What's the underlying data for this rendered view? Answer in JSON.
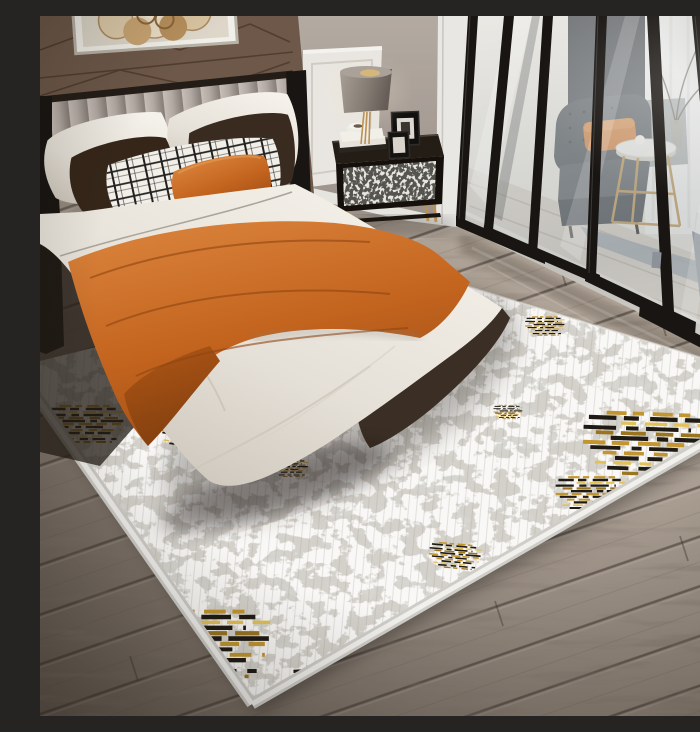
{
  "scene": {
    "setting": "modern bedroom staging photograph",
    "focus": "Distressed abstract area rug in gray, cream, gold and black under a bed with white duvet and burnt-orange throw",
    "time_of_day_light": "bright daylight from right-hand window"
  },
  "objects": {
    "wall_art": "abstract gold and cream framed wall art",
    "leather_wall": "brown upholstered accent wall with diagonal stitching",
    "headboard": "channel-tufted taupe headboard with dark frame",
    "white_pillows": "white sleeping pillows",
    "brown_pillows": "dark chocolate accent pillows",
    "plaid_pillow": "black and white plaid lumbar pillow",
    "orange_pillow": "burnt-orange lumbar pillow",
    "bed": "bed with draped white duvet",
    "orange_throw": "burnt-orange throw blanket across the bed",
    "nightstand": "black nightstand with patterned drawer and gold legs",
    "table_lamp": "gray drum-shade table lamp with gold stem",
    "decor_books": "stacked white books with cup and saucer",
    "picture_frames": "two black picture frames",
    "glass_partition": "black-framed glass partition doors",
    "armchair": "charcoal tufted armchair with orange cushion",
    "side_table": "round white side table with gold base",
    "branch_vase": "vase with dry branches",
    "lounge_rug": "blue-gray lounge rug behind partition",
    "lounge_chaise": "gray upholstered seat behind partition",
    "area_rug": "distressed abstract area rug with gold and black accents",
    "wood_floor": "gray-brown wood plank floor"
  },
  "colors": {
    "accent-orange": "#c4651f",
    "throw-orange-light": "#d9823b",
    "rug-gold": "#c2952f",
    "rug-gold-light": "#e3c158",
    "rug-ink": "#1f1a13",
    "rug-base": "#d4d1cb",
    "rug-white": "#efede8",
    "rug-gray": "#b4b1ab",
    "leather-brown": "#6d5849",
    "stitch-brown": "#4b3a2c",
    "wall-gray": "#a89e96",
    "wainscot-white": "#e9e6e1",
    "linen-white": "#f2efe9",
    "duvet-shadow": "#cfc8be",
    "pillow-brown": "#352619",
    "frame-black": "#191512",
    "glass-tint": "#b9bec0",
    "charcoal-chair": "#4b5056",
    "gold-metal": "#bb9254",
    "wood-light": "#b3a79b",
    "wood-dark": "#5f554c",
    "headboard-taupe": "#b5aca5"
  }
}
